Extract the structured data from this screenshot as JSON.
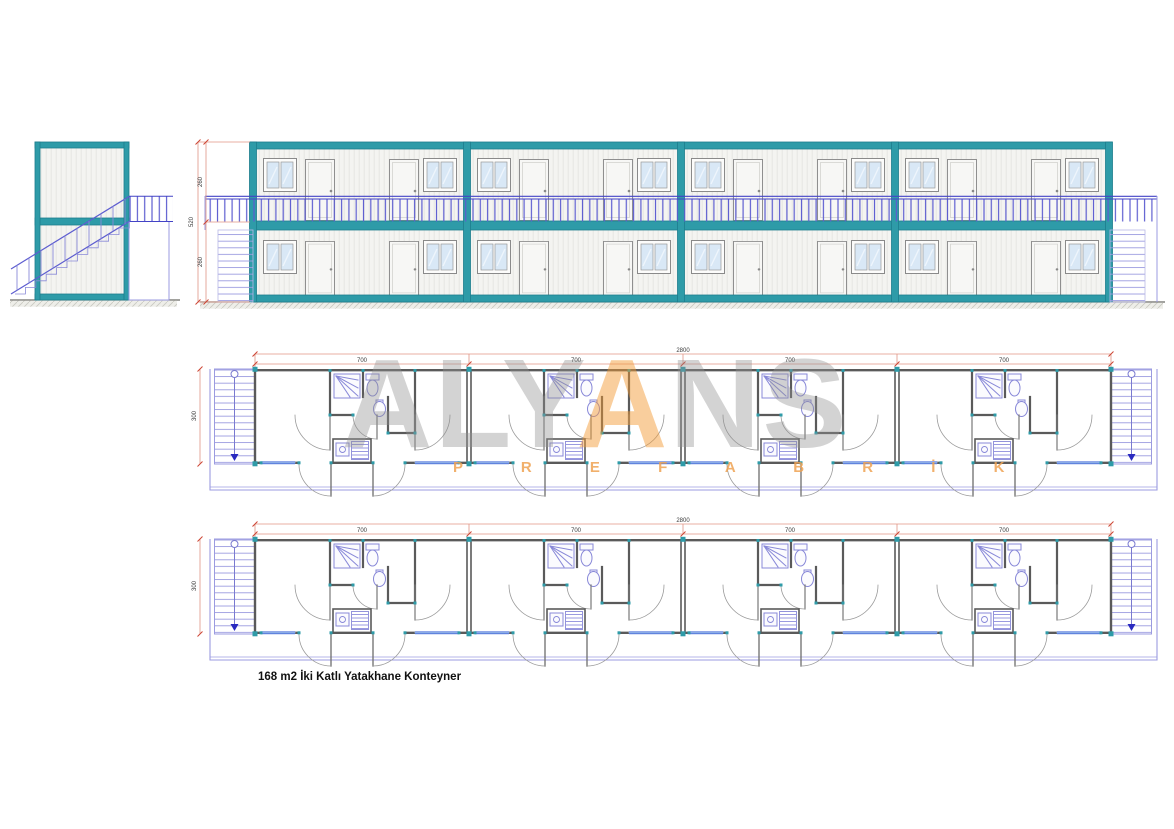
{
  "caption": "168 m2 İki Katlı Yatakhane Konteyner",
  "watermark": {
    "pre": "ALY",
    "accent": "A",
    "post": "NS",
    "subtitle": "P R E F A B R İ K"
  },
  "dims": {
    "plan_total": "2800",
    "plan_module": "700",
    "plan_depth": "300",
    "elev_total": "520",
    "elev_upper": "260",
    "elev_lower": "260"
  },
  "colors": {
    "frame_teal": "#2E9BA8",
    "frame_teal_dark": "#1D7D8D",
    "railing_blue": "#5D5DD0",
    "plan_fixture_violet": "#8888D8",
    "plan_wall_gray": "#5A5A5A",
    "dimension_salmon": "#E09484",
    "tick_red": "#CC4433",
    "watermark_orange": "#F2A65A",
    "window_glass_blue": "#D9E8F6"
  }
}
